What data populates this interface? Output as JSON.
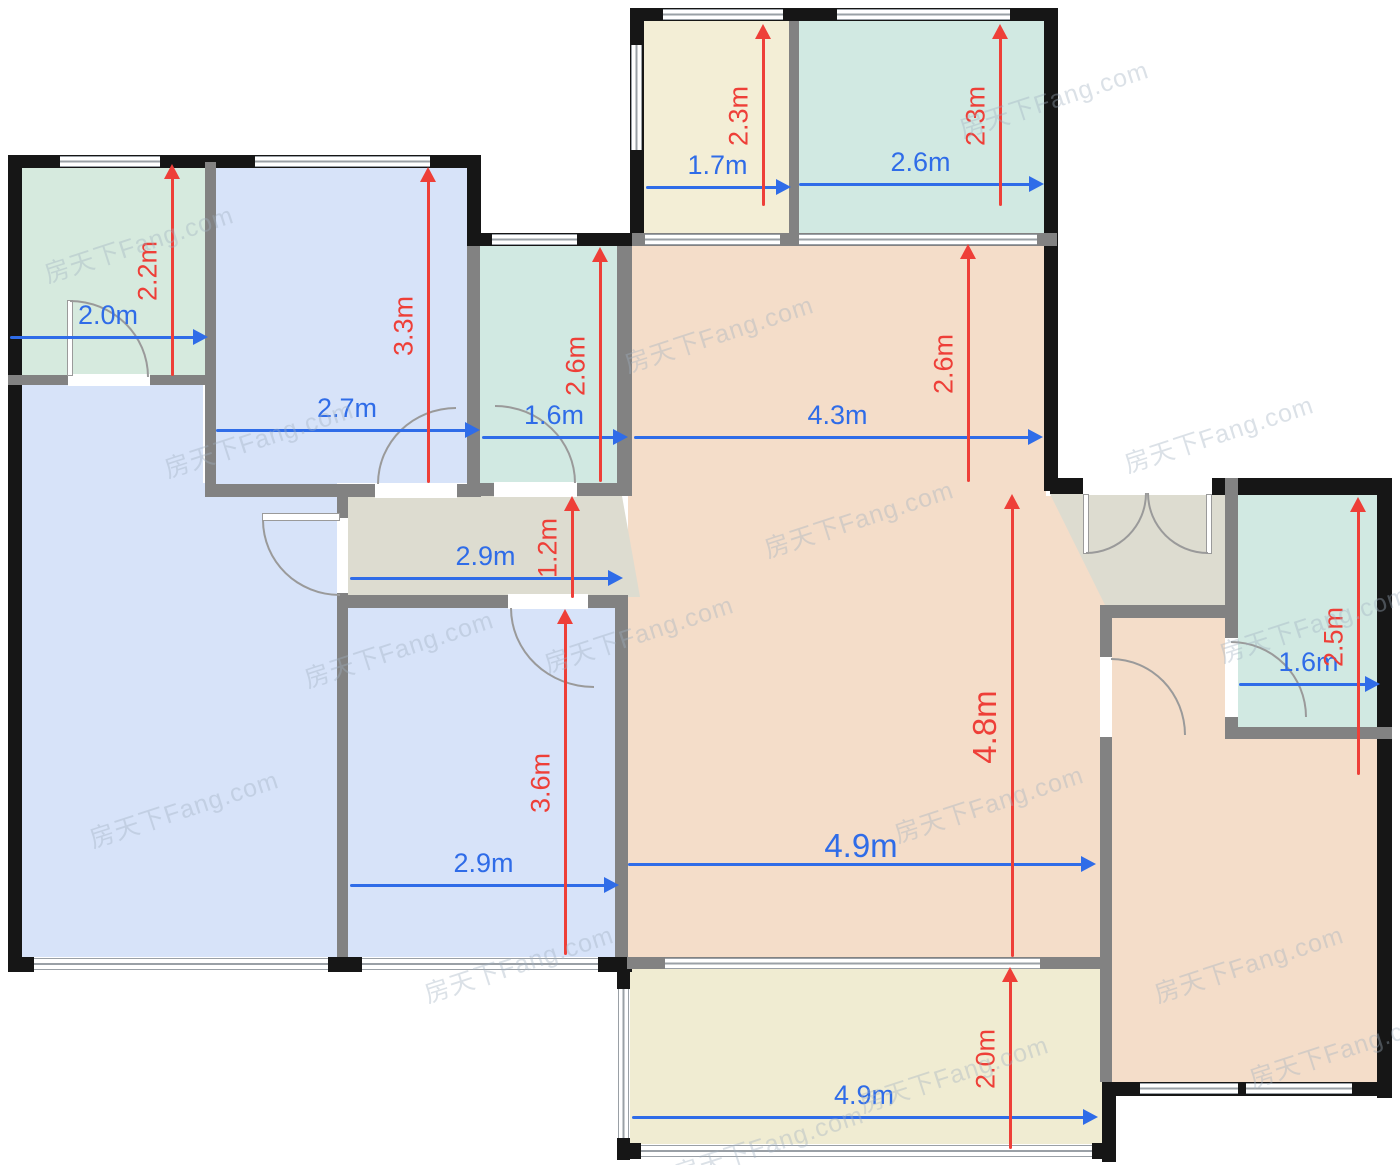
{
  "meta": {
    "type": "floor-plan",
    "units": "m"
  },
  "watermark": {
    "text": "房天下Fang.com"
  },
  "colors": {
    "dim_horizontal": "#2f6ce8",
    "dim_vertical": "#ee3f38",
    "room_green": "#d6eade",
    "room_teal": "#d1e9e2",
    "room_blue": "#d7e3f9",
    "room_peach": "#f4ddc9",
    "room_yellow": "#f3eed6",
    "room_hall": "#dddcd0",
    "wall_exterior": "#161616",
    "wall_interior": "#828282"
  },
  "dimensions": [
    {
      "id": "tl-bath-width",
      "axis": "horizontal",
      "label": "2.0m"
    },
    {
      "id": "tl-bedroom-width",
      "axis": "horizontal",
      "label": "2.7m"
    },
    {
      "id": "mid-bath-width",
      "axis": "horizontal",
      "label": "1.6m"
    },
    {
      "id": "top-balcony-width",
      "axis": "horizontal",
      "label": "1.7m"
    },
    {
      "id": "top-room-width",
      "axis": "horizontal",
      "label": "2.6m"
    },
    {
      "id": "dining-width",
      "axis": "horizontal",
      "label": "4.3m"
    },
    {
      "id": "hallway-width",
      "axis": "horizontal",
      "label": "2.9m"
    },
    {
      "id": "bottom-bedroom-width",
      "axis": "horizontal",
      "label": "2.9m"
    },
    {
      "id": "living-width",
      "axis": "horizontal",
      "label": "4.9m"
    },
    {
      "id": "right-bath-width",
      "axis": "horizontal",
      "label": "1.6m"
    },
    {
      "id": "bottom-balcony-width",
      "axis": "horizontal",
      "label": "4.9m"
    },
    {
      "id": "tl-bath-depth",
      "axis": "vertical",
      "label": "2.2m"
    },
    {
      "id": "tl-bedroom-depth",
      "axis": "vertical",
      "label": "3.3m"
    },
    {
      "id": "mid-bath-depth",
      "axis": "vertical",
      "label": "2.6m"
    },
    {
      "id": "top-balcony-depth",
      "axis": "vertical",
      "label": "2.3m"
    },
    {
      "id": "top-room-depth",
      "axis": "vertical",
      "label": "2.3m"
    },
    {
      "id": "dining-depth",
      "axis": "vertical",
      "label": "2.6m"
    },
    {
      "id": "hallway-depth",
      "axis": "vertical",
      "label": "1.2m"
    },
    {
      "id": "bottom-bedroom-depth",
      "axis": "vertical",
      "label": "3.6m"
    },
    {
      "id": "living-depth",
      "axis": "vertical",
      "label": "4.8m"
    },
    {
      "id": "right-bath-depth",
      "axis": "vertical",
      "label": "2.5m"
    },
    {
      "id": "bottom-balcony-depth",
      "axis": "vertical",
      "label": "2.0m"
    }
  ]
}
